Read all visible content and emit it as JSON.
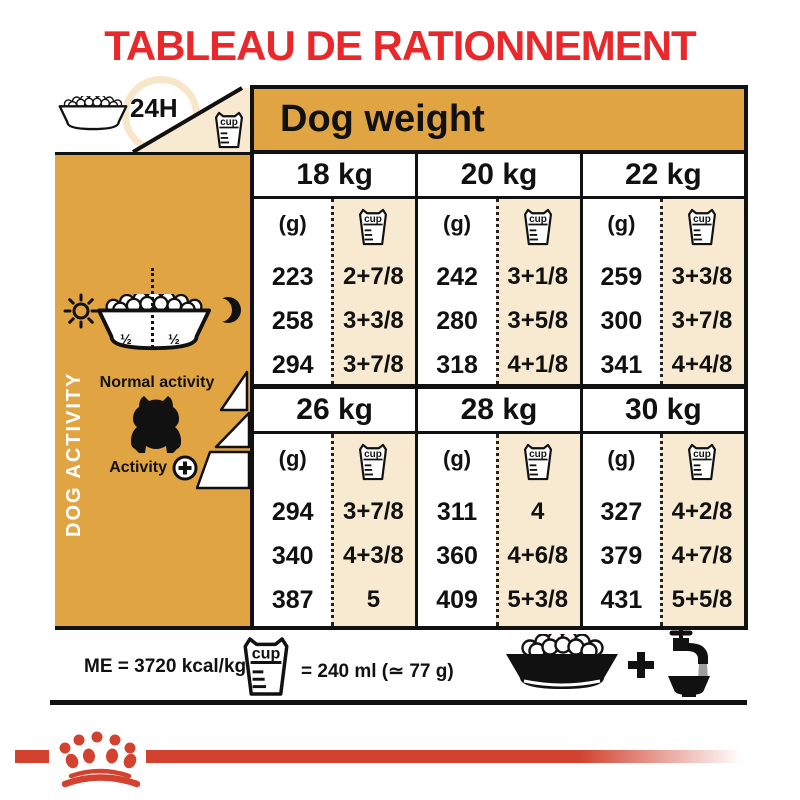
{
  "title": "TABLEAU DE RATIONNEMENT",
  "corner": {
    "daily": "24H"
  },
  "table": {
    "header": "Dog weight",
    "gram_unit": "(g)",
    "cup_label": "cup",
    "blocks": [
      {
        "columns": [
          {
            "weight": "18 kg",
            "rows": [
              {
                "g": "223",
                "cups": "2+7/8"
              },
              {
                "g": "258",
                "cups": "3+3/8"
              },
              {
                "g": "294",
                "cups": "3+7/8"
              }
            ]
          },
          {
            "weight": "20 kg",
            "rows": [
              {
                "g": "242",
                "cups": "3+1/8"
              },
              {
                "g": "280",
                "cups": "3+5/8"
              },
              {
                "g": "318",
                "cups": "4+1/8"
              }
            ]
          },
          {
            "weight": "22 kg",
            "rows": [
              {
                "g": "259",
                "cups": "3+3/8"
              },
              {
                "g": "300",
                "cups": "3+7/8"
              },
              {
                "g": "341",
                "cups": "4+4/8"
              }
            ]
          }
        ]
      },
      {
        "columns": [
          {
            "weight": "26 kg",
            "rows": [
              {
                "g": "294",
                "cups": "3+7/8"
              },
              {
                "g": "340",
                "cups": "4+3/8"
              },
              {
                "g": "387",
                "cups": "5"
              }
            ]
          },
          {
            "weight": "28 kg",
            "rows": [
              {
                "g": "311",
                "cups": "4"
              },
              {
                "g": "360",
                "cups": "4+6/8"
              },
              {
                "g": "409",
                "cups": "5+3/8"
              }
            ]
          },
          {
            "weight": "30 kg",
            "rows": [
              {
                "g": "327",
                "cups": "4+2/8"
              },
              {
                "g": "379",
                "cups": "4+7/8"
              },
              {
                "g": "431",
                "cups": "5+5/8"
              }
            ]
          }
        ]
      }
    ]
  },
  "sidebar": {
    "label": "DOG ACTIVITY",
    "half_left": "½",
    "half_right": "½",
    "normal_label": "Normal activity",
    "activity_label": "Activity",
    "plus": "+"
  },
  "legend": {
    "me": "ME = 3720 kcal/kg",
    "equiv": "= 240 ml (≃ 77 g)",
    "plus": "+"
  },
  "colors": {
    "gold": "#E0A443",
    "cream": "#F8EAD0",
    "title_red": "#E8282B",
    "logo_red": "#D2422F"
  }
}
